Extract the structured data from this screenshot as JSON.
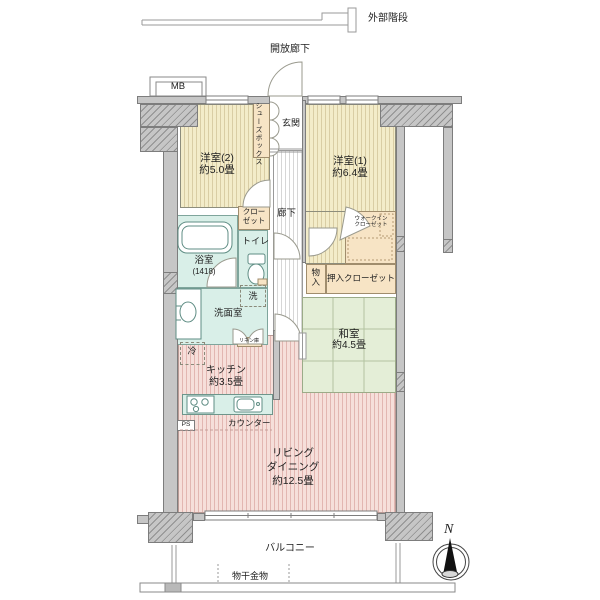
{
  "title": "マンション間取り図",
  "labels": {
    "ext_stairs": "外部階段",
    "open_corridor": "開放廊下",
    "mb": "MB",
    "bedroom2_name": "洋室(2)",
    "bedroom2_size": "約5.0畳",
    "bedroom1_name": "洋室(1)",
    "bedroom1_size": "約6.4畳",
    "shoebox": "シューズボックス",
    "entrance": "玄関",
    "closet_l1": "クロー",
    "closet_l2": "ゼット",
    "hallway": "廊下",
    "toilet": "トイレ",
    "bath_name": "浴室",
    "bath_size": "(1418)",
    "washer": "洗",
    "washroom": "洗面室",
    "linen": "リネン庫",
    "storage": "物入",
    "oshiire": "押入クローゼット",
    "wic_l1": "ウォークイン",
    "wic_l2": "クローゼット",
    "washitsu_name": "和室",
    "washitsu_size": "約4.5畳",
    "fridge": "冷",
    "kitchen_name": "キッチン",
    "kitchen_size": "約3.5畳",
    "counter": "カウンター",
    "ps": "PS",
    "living_l1": "リビング",
    "living_l2": "ダイニング",
    "living_l3": "約12.5畳",
    "balcony": "バルコニー",
    "laundry": "物干金物",
    "compass_n": "N"
  },
  "palette": {
    "wood_floor": "#f3ecc9",
    "wood_stripe": "#d9cda4",
    "ldk_floor": "#f6dfda",
    "ldk_stripe": "#e2b6b1",
    "tatami": "#e4eed7",
    "wet_area": "#d9efe8",
    "closet": "#f7e4c5",
    "wall": "#c6c6c6",
    "text": "#222222"
  }
}
